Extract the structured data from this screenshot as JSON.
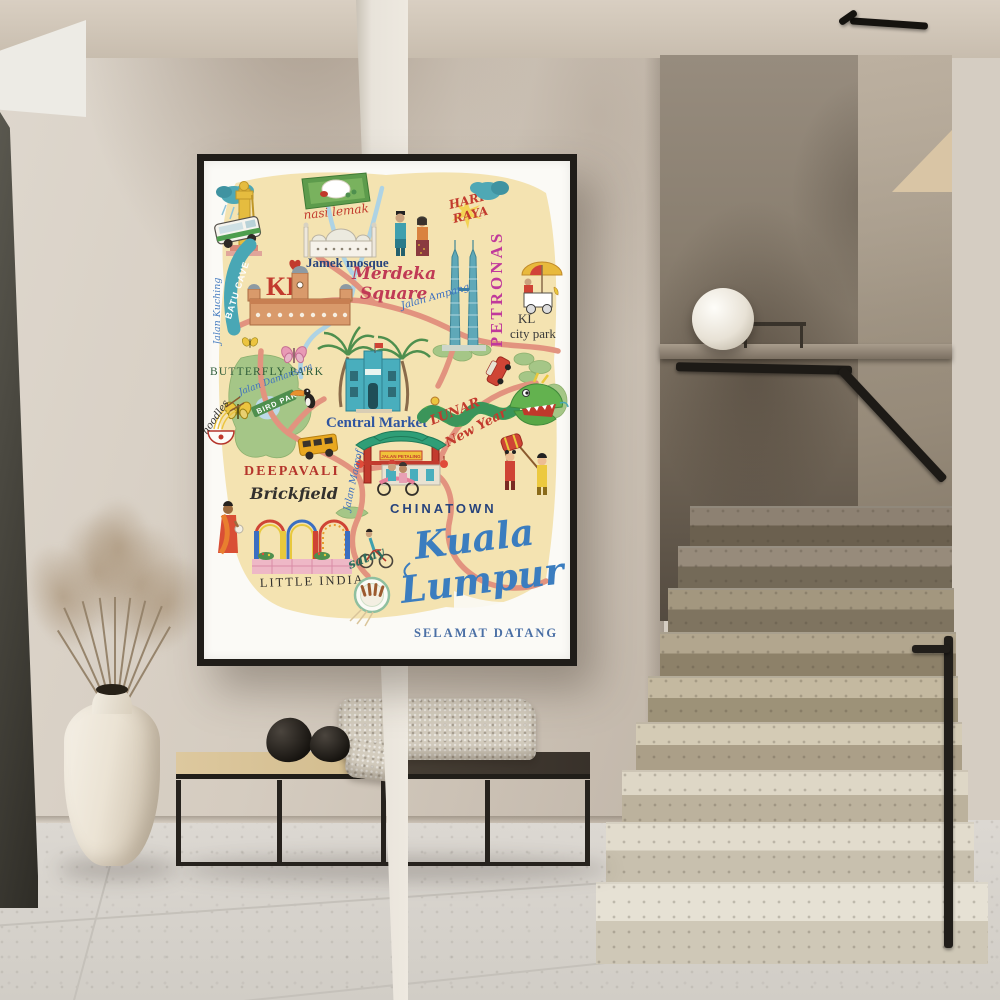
{
  "scene": {
    "colors": {
      "wall": "#d3cabf",
      "stair_wall": "#7b7062",
      "floor": "#d9d5cf",
      "frame": "#201d19",
      "bench_wood": "#d2bc8e",
      "railing": "#1d1a16"
    }
  },
  "poster": {
    "colors": {
      "map_wash": "#f3e0aa",
      "road": "#e2937f",
      "park": "#a5c687",
      "water": "#aed3e4",
      "title_blue": "#3b7dbf",
      "script_red": "#c23b2e",
      "petronas_magenta": "#c0399b",
      "teal": "#49a7b5"
    },
    "labels": {
      "jalan_kuching": "Jalan Kuching",
      "batu_cave": "BATU CAVE",
      "kl_monogram": "KL",
      "nasi_lemak": "nasi lemak",
      "jamek_mosque": "Jamek mosque",
      "hari_raya_line1": "HARI",
      "hari_raya_line2": "RAYA",
      "petronas": "PETRONAS",
      "merdeka_line1": "Merdeka",
      "merdeka_line2": "Square",
      "jalan_ampang": "Jalan Ampang",
      "kl_city_park_line1": "KL",
      "kl_city_park_line2": "city park",
      "butterfly_park": "BUTTERFLY PARK",
      "jalan_damansara": "Jalan Damansara",
      "bird_park": "BIRD PARK",
      "central_market": "Central Market",
      "lunar_line1": "LUNAR",
      "lunar_line2": "New Year",
      "deepavali": "DEEPAVALI",
      "brickfield": "Brickfield",
      "jalan_maarof": "Jalan Maarof",
      "chinatown": "CHINATOWN",
      "petaling_sign": "JALAN PETALING",
      "little_india": "LITTLE INDIA",
      "satay": "satay",
      "noodles": "noodles",
      "title_line1": "Kuala",
      "title_line2": "Lumpur",
      "selamat_datang": "SELAMAT DATANG"
    }
  }
}
